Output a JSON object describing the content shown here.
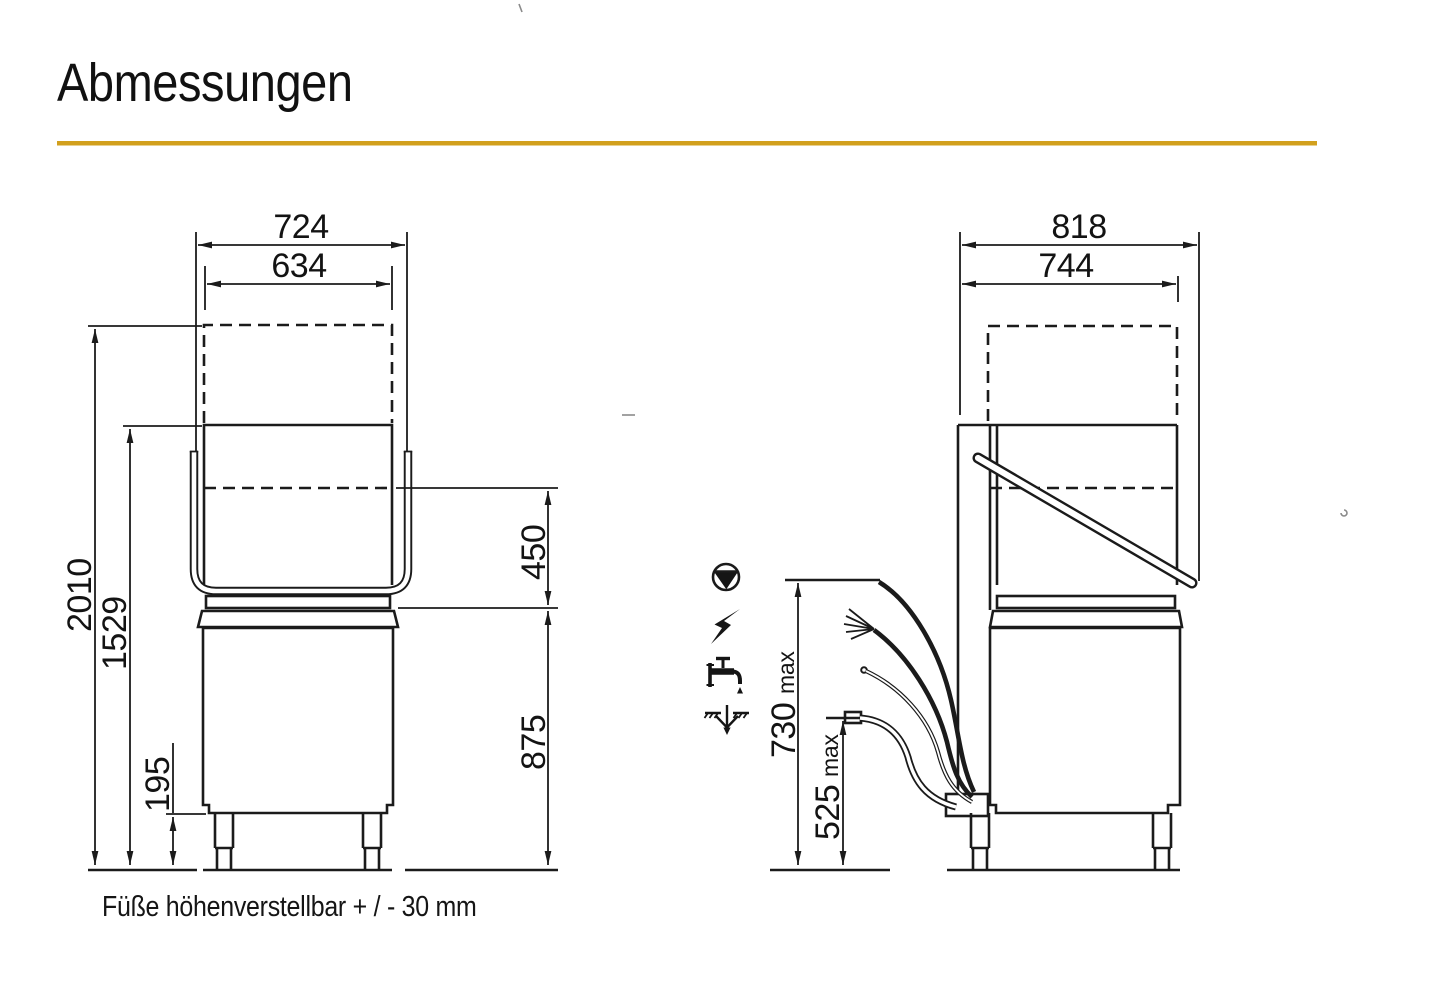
{
  "title": "Abmessungen",
  "accent_color": "#D2A01D",
  "front_view": {
    "caption": "Füße höhenverstellbar + / - 30 mm",
    "dim_outer_width": "724",
    "dim_hood_width": "634",
    "dim_total_height_hood_open": "2010",
    "dim_height_hood_raised": "1529",
    "dim_leg_height": "195",
    "dim_opening_height": "450",
    "dim_table_height": "875"
  },
  "side_view": {
    "dim_outer_depth": "818",
    "dim_body_depth": "744",
    "dim_connection_height": "730",
    "dim_connection_height_suffix": "max",
    "dim_drain_height": "525",
    "dim_drain_height_suffix": "max",
    "connection_icons": [
      {
        "name": "drain-pump-icon"
      },
      {
        "name": "electric-connection-icon"
      },
      {
        "name": "water-tap-icon"
      },
      {
        "name": "waste-water-drain-icon"
      }
    ]
  }
}
